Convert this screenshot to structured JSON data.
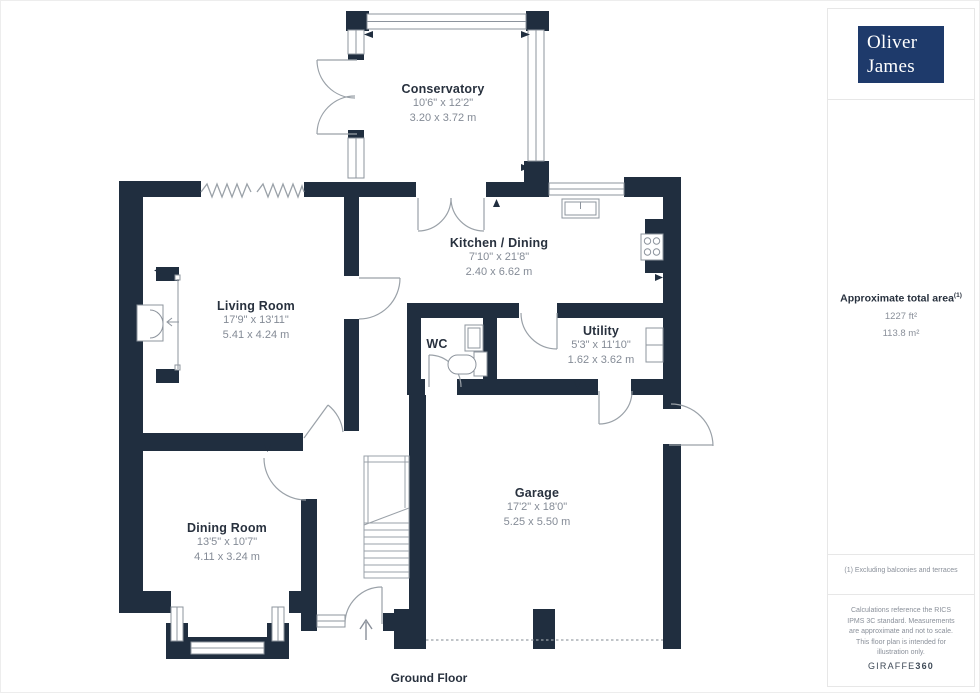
{
  "branding": {
    "logo_line1": "Oliver",
    "logo_line2": "James",
    "logo_bg": "#1e3a6b",
    "giraffe_normal": "GIRAFFE",
    "giraffe_bold": "360"
  },
  "sidebar": {
    "area_title": "Approximate total area",
    "area_sup": "(1)",
    "area_ft": "1227 ft²",
    "area_m": "113.8 m²",
    "footnote": "(1) Excluding balconies and terraces",
    "disclaimer": "Calculations reference the RICS IPMS 3C standard. Measurements are approximate and not to scale. This floor plan is intended for illustration only."
  },
  "labels": {
    "ground_floor": "Ground Floor"
  },
  "rooms": [
    {
      "name": "Conservatory",
      "imperial": "10'6\" x 12'2\"",
      "metric": "3.20 x 3.72 m"
    },
    {
      "name": "Kitchen / Dining",
      "imperial": "7'10\" x 21'8\"",
      "metric": "2.40 x 6.62 m"
    },
    {
      "name": "Living Room",
      "imperial": "17'9\" x 13'11\"",
      "metric": "5.41 x 4.24 m"
    },
    {
      "name": "WC",
      "imperial": "",
      "metric": ""
    },
    {
      "name": "Utility",
      "imperial": "5'3\" x 11'10\"",
      "metric": "1.62 x 3.62 m"
    },
    {
      "name": "Garage",
      "imperial": "17'2\" x 18'0\"",
      "metric": "5.25 x 5.50 m"
    },
    {
      "name": "Dining Room",
      "imperial": "13'5\" x 10'7\"",
      "metric": "4.11 x 3.24 m"
    }
  ],
  "colors": {
    "wall": "#202e3f",
    "line": "#9aa1a8",
    "text_dark": "#28313e",
    "text_muted": "#848b96"
  }
}
